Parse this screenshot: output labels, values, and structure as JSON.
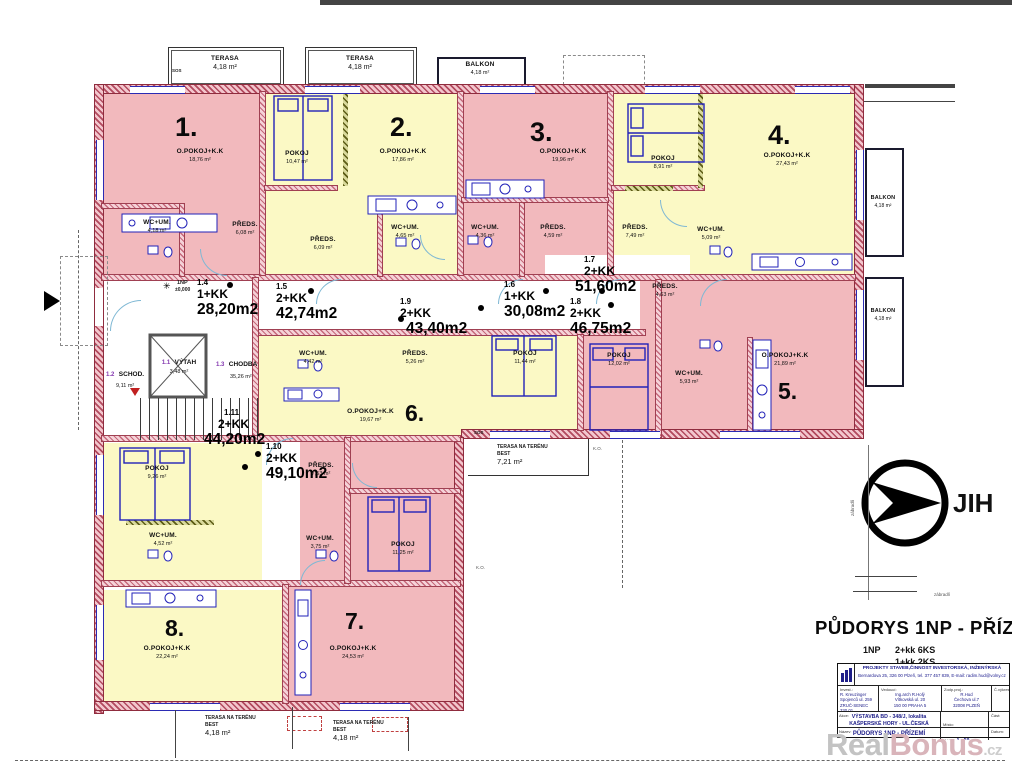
{
  "plan": {
    "apartments": [
      {
        "num": "1.",
        "room": "O.POKOJ+K.K",
        "area": "18,76 m²"
      },
      {
        "num": "2.",
        "room": "O.POKOJ+K.K",
        "area": "17,86 m²"
      },
      {
        "num": "3.",
        "room": "O.POKOJ+K.K",
        "area": "19,96 m²"
      },
      {
        "num": "4.",
        "room": "O.POKOJ+K.K",
        "area": "27,43 m²"
      },
      {
        "num": "5.",
        "room": "O.POKOJ+K.K",
        "area": "21,89 m²"
      },
      {
        "num": "6.",
        "room": "O.POKOJ+K.K",
        "area": "19,67 m²"
      },
      {
        "num": "7.",
        "room": "O.POKOJ+K.K",
        "area": "24,53 m²"
      },
      {
        "num": "8.",
        "room": "O.POKOJ+K.K",
        "area": "22,24 m²"
      }
    ],
    "units": [
      {
        "id": "1.4",
        "type": "1+KK",
        "area": "28,20m2"
      },
      {
        "id": "1.5",
        "type": "2+KK",
        "area": "42,74m2"
      },
      {
        "id": "1.9",
        "type": "2+KK",
        "area": "43,40m2"
      },
      {
        "id": "1.6",
        "type": "1+KK",
        "area": "30,08m2"
      },
      {
        "id": "1.7",
        "type": "2+KK",
        "area": "51,60m2"
      },
      {
        "id": "1.8",
        "type": "2+KK",
        "area": "46,75m2"
      },
      {
        "id": "1.10",
        "type": "2+KK",
        "area": "49,10m2"
      },
      {
        "id": "1.11",
        "type": "2+KK",
        "area": "44,20m2"
      }
    ],
    "rooms": {
      "a1_wc": {
        "n": "WC+UM.",
        "a": "4,18 m²"
      },
      "a1_pr": {
        "n": "PŘEDS.",
        "a": "6,08 m²"
      },
      "a2_pokoj": {
        "n": "POKOJ",
        "a": "10,47 m²"
      },
      "a2_pr": {
        "n": "PŘEDS.",
        "a": "6,09 m²"
      },
      "a2_wc": {
        "n": "WC+UM.",
        "a": "4,65 m²"
      },
      "a3_wc": {
        "n": "WC+UM.",
        "a": "4,36 m²"
      },
      "a3_pr": {
        "n": "PŘEDS.",
        "a": "4,59 m²"
      },
      "a4_pokoj": {
        "n": "POKOJ",
        "a": "8,91 m²"
      },
      "a4_pr": {
        "n": "PŘEDS.",
        "a": "7,49 m²"
      },
      "a4_wc": {
        "n": "WC+UM.",
        "a": "5,09 m²"
      },
      "a5_wc": {
        "n": "WC+UM.",
        "a": "5,93 m²"
      },
      "u18_pr": {
        "n": "PŘEDS.",
        "a": "4,63 m²"
      },
      "u18_pokoj": {
        "n": "POKOJ",
        "a": "12,02 m²"
      },
      "u19_wc": {
        "n": "WC+UM.",
        "a": "4,42 m²"
      },
      "u19_pr": {
        "n": "PŘEDS.",
        "a": "5,26 m²"
      },
      "u19_pokoj": {
        "n": "POKOJ",
        "a": "11,44 m²"
      },
      "u110_pr": {
        "n": "PŘEDS.",
        "a": "7,53 m²"
      },
      "u110_wc": {
        "n": "WC+UM.",
        "a": "3,75 m²"
      },
      "u110_pokoj": {
        "n": "POKOJ",
        "a": "11,25 m²"
      },
      "u111_pokoj": {
        "n": "POKOJ",
        "a": "9,26 m²"
      },
      "u111_wc": {
        "n": "WC+UM.",
        "a": "4,52 m²"
      }
    },
    "core": {
      "vytah": {
        "id": "1.1",
        "n": "VÝTAH",
        "a": "3,48 m²"
      },
      "schod": {
        "id": "1.2",
        "n": "SCHOD.",
        "a": "9,11 m²"
      },
      "chodba": {
        "id": "1.3",
        "n": "CHODBA",
        "a": "35,26 m²"
      }
    },
    "terraces": {
      "top1": {
        "n": "TERASA",
        "a": "4,18 m²"
      },
      "top2": {
        "n": "TERASA",
        "a": "4,18 m²"
      },
      "balkon_top": {
        "n": "BALKON",
        "a": "4,18 m²"
      },
      "balkon_r1": {
        "n": "BALKON",
        "a": "4,18 m²"
      },
      "balkon_r2": {
        "n": "BALKON",
        "a": "4,18 m²"
      },
      "mid": {
        "l1": "TERASA NA TERÉNU",
        "l2": "BEST",
        "a": "7,21 m²"
      },
      "bot1": {
        "l1": "TERASA NA TERÉNU",
        "l2": "BEST",
        "a": "4,18 m²"
      },
      "bot2": {
        "l1": "TERASA NA TERÉNU",
        "l2": "BEST",
        "a": "4,18 m²"
      }
    },
    "marks": {
      "sos": "SOS",
      "ko": "K.O.",
      "zabradli": "zábradlí",
      "level1": "1NP",
      "level2": "±0,000"
    },
    "compass": {
      "label": "JIH"
    }
  },
  "heading": {
    "title": "PŮDORYS 1NP - PŘÍZEMÍ",
    "floor": "1NP",
    "s1": "2+kk 6KS",
    "s2": "1+kk 2KS"
  },
  "titleblock": {
    "company1": "PROJEKTY STAVEB,ČINNOST INVESTORSKÁ, INŽENÝRSKÁ",
    "company2": "Bernardova 25, 326 00 Plzeň, tel. 377 457 839, E-mail: radim.hud@volny.cz",
    "invest_label": "Invest.:",
    "invest1": "R. Kreuzinger",
    "invest2": "Spojenců ul. 259",
    "invest3": "ZRUČ-SENEC 330 01",
    "ved_label": "Vedoucí:",
    "ved1": "Ing.arch R.Holý",
    "ved2": "Vítkovská ul. 20",
    "ved3": "150 00 PRAHA 5",
    "zodp_label": "Zodp.proj.:",
    "zodp1": "R.Hud",
    "zodp2": "Čechova ul.7",
    "zodp3": "32008 PLZEŇ",
    "cis_label": "Č.výkresu:",
    "akce_label": "Akce:",
    "akce1": "VÝSTAVBA BD - 348/J, lokalita",
    "akce2": "KAŠPERSKÉ HORY - UL.ČESKÁ",
    "misto_label": "Místo:",
    "misto1": "KAŠPER. HORY",
    "misto2": "p.č. 150/1 k.ú.",
    "cast_label": "Část:",
    "nazev_label": "Název:",
    "nazev": "PŮDORYS 1NP - PŘÍZEMÍ",
    "mer_label": "Měř.:",
    "mer": "1 : 50",
    "datum_label": "Datum:"
  },
  "watermark": {
    "p1": "Real",
    "p2": "Bonus",
    "p3": ".cz"
  }
}
